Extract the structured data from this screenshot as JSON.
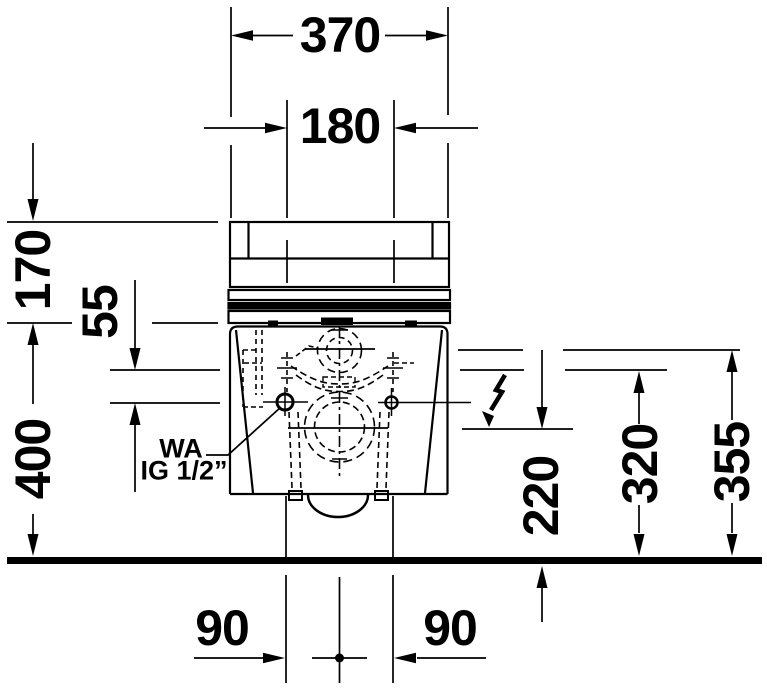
{
  "drawing": {
    "dims": {
      "overall_width": "370",
      "fixing_centers": "180",
      "top_height": "170",
      "seat_drop": "55",
      "mount_height": "400",
      "connection_height": "220",
      "height_320": "320",
      "height_355": "355",
      "offset_left": "90",
      "offset_right": "90"
    },
    "labels": {
      "water_abbr": "WA",
      "thread": "IG 1/2”"
    },
    "icons": {
      "electrical": "lightning-bolt"
    },
    "colors": {
      "line": "#000000",
      "background": "#ffffff"
    }
  }
}
